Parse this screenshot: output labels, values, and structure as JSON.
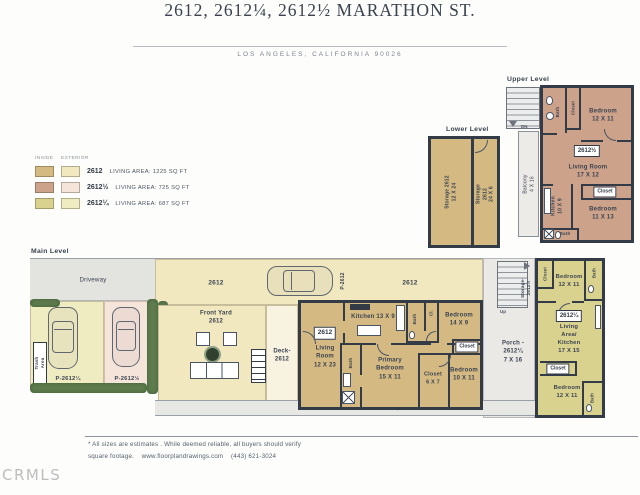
{
  "header": {
    "title": "2612, 2612¼, 2612½ MARATHON ST.",
    "subtitle": "LOS ANGELES, CALIFORNIA  90026"
  },
  "legend": {
    "inside_header": "INSIDE",
    "exterior_header": "EXTERIOR",
    "rows": [
      {
        "unit": "2612",
        "area": "LIVING AREA:  1225 SQ FT",
        "inside_color": "#d4b982",
        "exterior_color": "#f2e8c0"
      },
      {
        "unit": "2612½",
        "area": "LIVING AREA:  725 SQ FT",
        "inside_color": "#cda28a",
        "exterior_color": "#f5e4da"
      },
      {
        "unit": "2612¼",
        "area": "LIVING AREA:  687 SQ FT",
        "inside_color": "#d9d28f",
        "exterior_color": "#f0ecc2"
      }
    ]
  },
  "upper_level": {
    "title": "Upper Level",
    "dn": "DN",
    "balcony": "Balcony 4 X 16",
    "bath_top": "Bath",
    "closet_top": "Closet",
    "bedroom_top": "Bedroom\n12 X 11",
    "unit_tag": "2612½",
    "living": "Living Room\n17 X 12",
    "kitchen": "Kitchen\n10 X 9",
    "closet_mid": "Closet",
    "bedroom_bottom": "Bedroom\n11 X 13",
    "bath_bottom": "Bath"
  },
  "lower_level": {
    "title": "Lower Level",
    "storage_left": "Storage 2612\n12 X 24",
    "storage_right": "Storage 2612\n24 X 6"
  },
  "main_level": {
    "title": "Main Level",
    "driveway": "Driveway",
    "trash": "Trash Area",
    "parking_quarter": "P-2612¼",
    "parking_half": "P-2612½",
    "yard_tag_left": "2612",
    "car_tag": "P-2612",
    "yard_tag_right": "2612",
    "front_yard": "Front Yard\n2612",
    "deck": "Deck-\n2612",
    "house": {
      "unit_tag": "2612",
      "living": "Living\nRoom\n12 X 23",
      "kitchen": "Kitchen 13 X 9",
      "bath_top": "Bath",
      "closet_small": "Cl.",
      "bedroom_right": "Bedroom\n14 X 9",
      "closet_right": "Closet",
      "bath_primary": "Bath",
      "primary_bedroom": "Primary\nBedroom\n15 X 11",
      "closet_mid": "Closet\n6 X 7",
      "bedroom_bottom": "Bedroom\n10 X 11"
    },
    "stairs_up": "Up",
    "storage_half": "Storage-\n2612½",
    "porch": "Porch -\n2612¼\n7 X 16",
    "unit_quarter": {
      "closet_top": "Closet",
      "bedroom_top": "Bedroom\n12 X 11",
      "bath_top": "Bath",
      "unit_tag": "2612¼",
      "living": "Living Area/\nKitchen\n17 X 15",
      "closet_mid": "Closet",
      "bedroom_bottom": "Bedroom\n12 X 11",
      "bath_bottom": "Bath"
    },
    "common_area": "Common Area 2612¼ + 2612½"
  },
  "footer": {
    "disclaimer_line1": "* All sizes are estimates . While deemed reliable, all buyers should verify",
    "disclaimer_line2": "square footage.    www.floorplandrawings.com    (443) 621-3024",
    "logo": "CRMLS"
  },
  "palette": {
    "wall": "#333b47",
    "driveway": "#e3e3e0",
    "walkway": "#eae9e6",
    "hedge": "#5e7c4e",
    "deck": "#f8f3e1"
  }
}
